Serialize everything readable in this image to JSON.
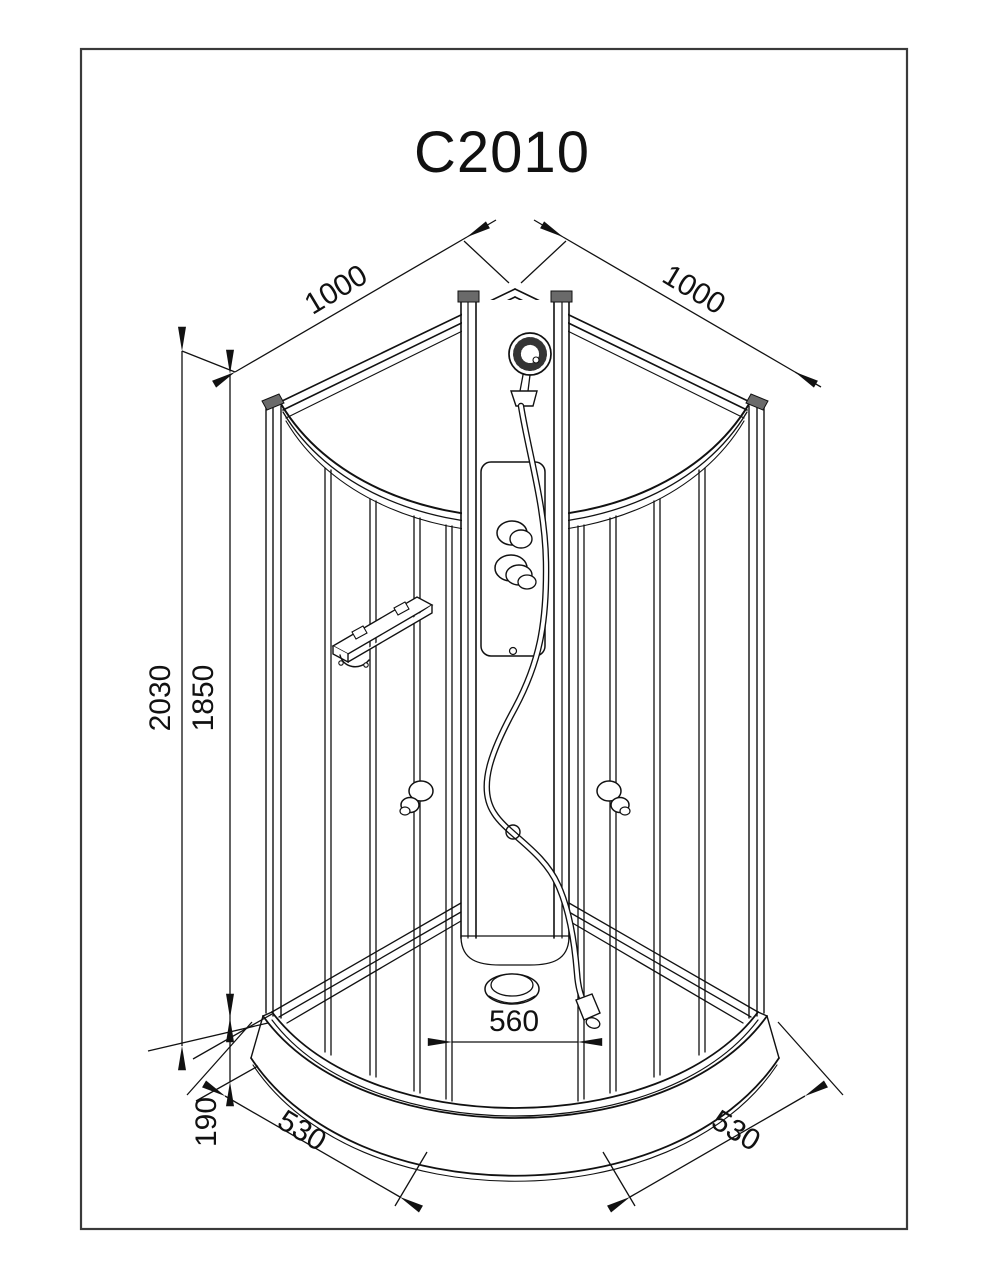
{
  "page": {
    "background": "#ffffff",
    "line_color": "#111111"
  },
  "drawing": {
    "title": "C2010",
    "dimensions": {
      "wall_left_width": "1000",
      "wall_right_width": "1000",
      "height_total": "2030",
      "height_glass": "1850",
      "tray_height": "190",
      "door_opening_width": "560",
      "front_left_segment": "530",
      "front_right_segment": "530"
    }
  }
}
